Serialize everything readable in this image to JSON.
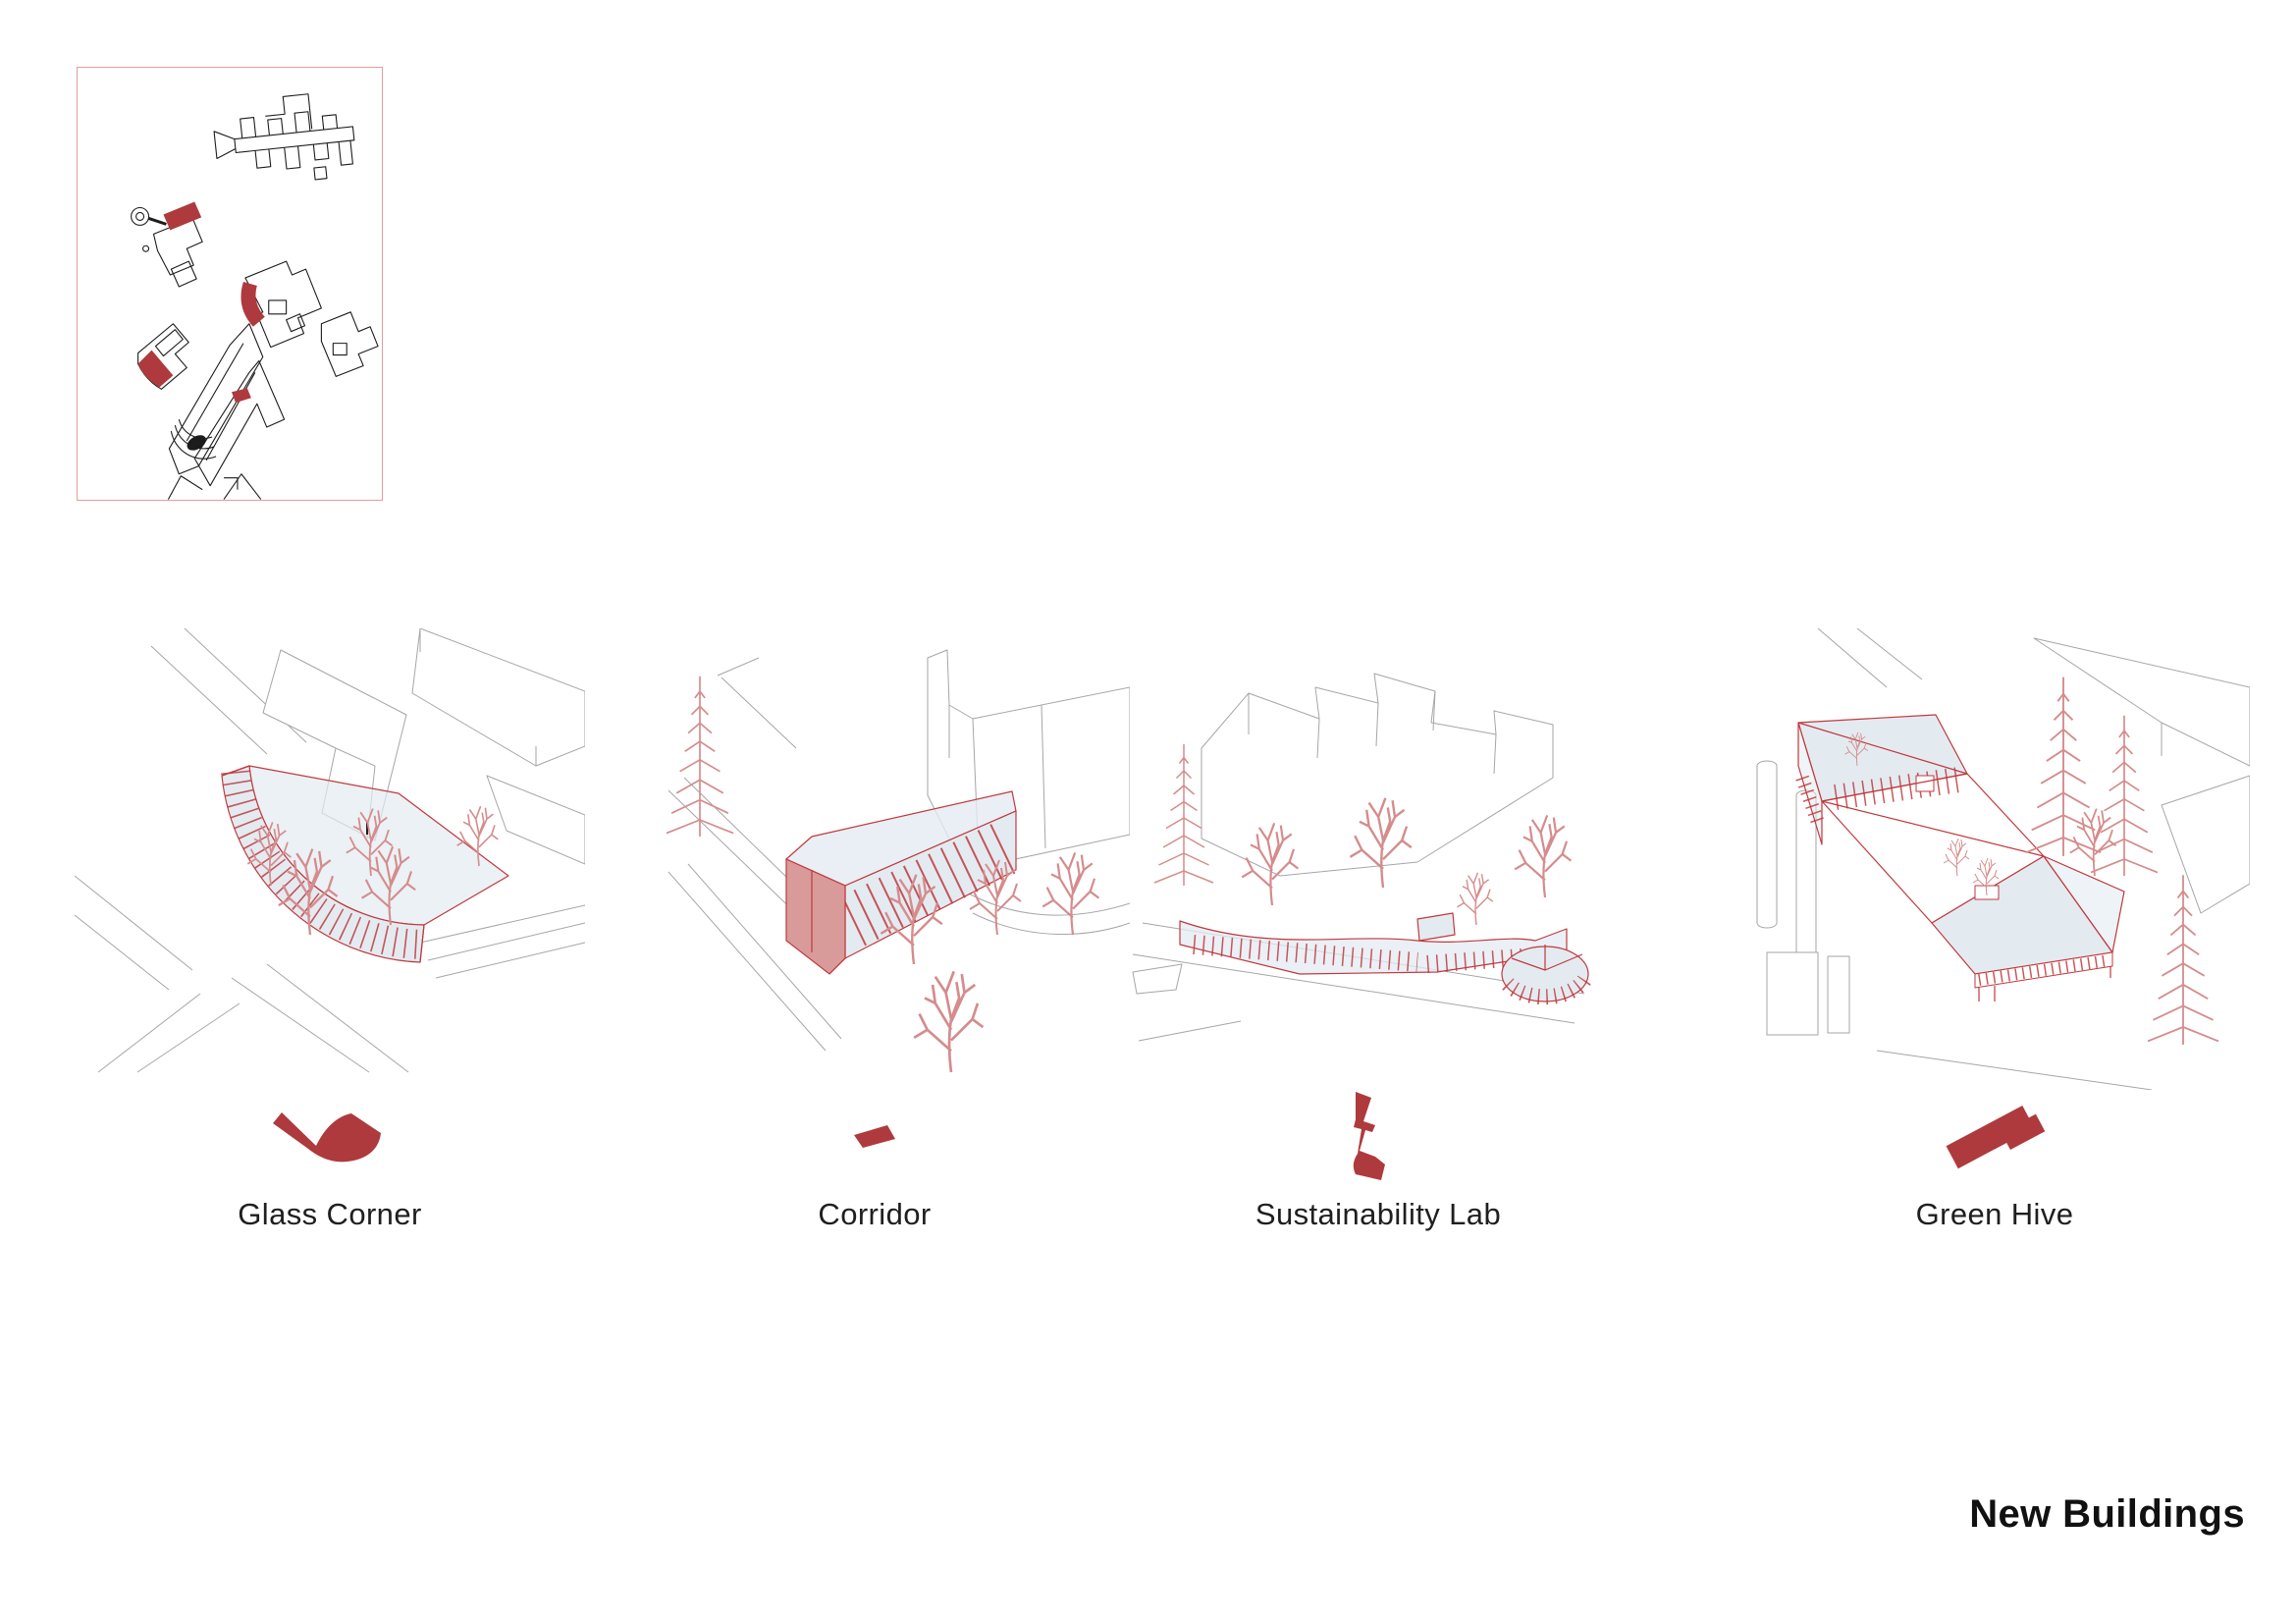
{
  "title": "New Buildings",
  "panels": [
    {
      "id": "glass-corner",
      "label": "Glass Corner",
      "icon": "glass-corner-plan-icon"
    },
    {
      "id": "corridor",
      "label": "Corridor",
      "icon": "corridor-plan-icon"
    },
    {
      "id": "sustainability-lab",
      "label": "Sustainability Lab",
      "icon": "sustainability-lab-plan-icon"
    },
    {
      "id": "green-hive",
      "label": "Green Hive",
      "icon": "green-hive-plan-icon"
    }
  ],
  "colors": {
    "red_solid": "#ae3a3d",
    "red_line": "#c0393d",
    "red_soft": "#d99a9a",
    "tree_red": "#d58c8c",
    "glass": "#e3ebf1",
    "gray_line": "#a6a6aa",
    "ink": "#1c1c1c",
    "frame_pink": "#e59c9c",
    "text": "#1f1f1f",
    "background": "#ffffff"
  }
}
